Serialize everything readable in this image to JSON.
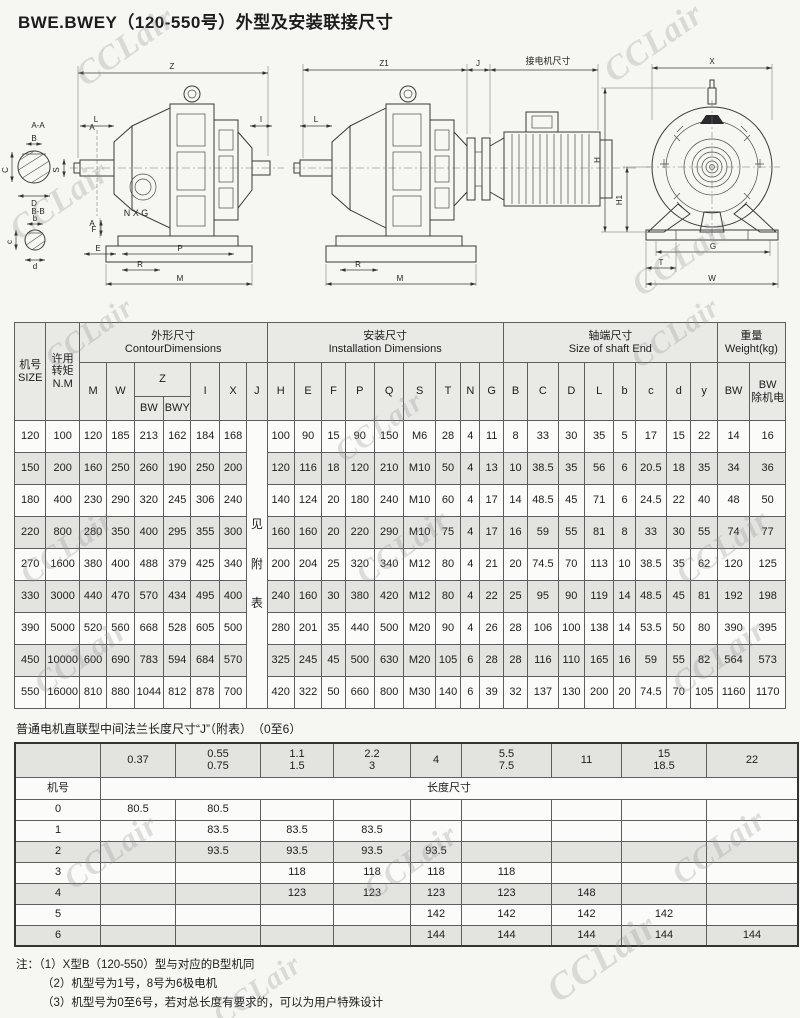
{
  "page": {
    "title": "BWE.BWEY（120-550号）外型及安装联接尺寸",
    "watermark": "CCLair"
  },
  "drawings": {
    "left": {
      "aa": "A-A",
      "bb": "B-B",
      "B": "B",
      "C": "C",
      "D": "D",
      "b": "b",
      "c": "c",
      "d": "d",
      "Z": "Z",
      "L": "L",
      "I": "I",
      "S": "S",
      "A": "A",
      "E": "E",
      "F": "F",
      "R": "R",
      "P": "P",
      "M": "M",
      "NXG": "N X G"
    },
    "middle": {
      "Z1": "Z1",
      "J": "J",
      "motor": "接电机尺寸",
      "L": "L",
      "R": "R",
      "M": "M"
    },
    "right": {
      "X": "X",
      "H": "H",
      "H1": "H1",
      "G": "G",
      "T": "T",
      "W": "W"
    }
  },
  "main_table": {
    "h_size": "机号\nSIZE",
    "h_torque": "许用\n转矩\nN.M",
    "h_contour": "外形尺寸\nContourDimensions",
    "h_install": "安装尺寸\nInstallation  Dimensions",
    "h_shaft": "轴端尺寸\nSize of shaft End",
    "h_weight": "重量\nWeight(kg)",
    "letters": [
      "M",
      "W",
      "Z",
      "I",
      "X",
      "J",
      "H",
      "E",
      "F",
      "P",
      "Q",
      "S",
      "T",
      "N",
      "G",
      "B",
      "C",
      "D",
      "L",
      "b",
      "c",
      "d",
      "y",
      "BW",
      "BW\n除机电"
    ],
    "z_sub": [
      "BW",
      "BWY"
    ],
    "j_note": "见附表",
    "rows": [
      [
        "120",
        "100",
        "120",
        "185",
        "213",
        "162",
        "184",
        "168",
        "100",
        "90",
        "15",
        "90",
        "150",
        "M6",
        "28",
        "4",
        "11",
        "8",
        "33",
        "30",
        "35",
        "5",
        "17",
        "15",
        "22",
        "14",
        "16"
      ],
      [
        "150",
        "200",
        "160",
        "250",
        "260",
        "190",
        "250",
        "200",
        "120",
        "116",
        "18",
        "120",
        "210",
        "M10",
        "50",
        "4",
        "13",
        "10",
        "38.5",
        "35",
        "56",
        "6",
        "20.5",
        "18",
        "35",
        "34",
        "36"
      ],
      [
        "180",
        "400",
        "230",
        "290",
        "320",
        "245",
        "306",
        "240",
        "140",
        "124",
        "20",
        "180",
        "240",
        "M10",
        "60",
        "4",
        "17",
        "14",
        "48.5",
        "45",
        "71",
        "6",
        "24.5",
        "22",
        "40",
        "48",
        "50"
      ],
      [
        "220",
        "800",
        "280",
        "350",
        "400",
        "295",
        "355",
        "300",
        "160",
        "160",
        "20",
        "220",
        "290",
        "M10",
        "75",
        "4",
        "17",
        "16",
        "59",
        "55",
        "81",
        "8",
        "33",
        "30",
        "55",
        "74",
        "77"
      ],
      [
        "270",
        "1600",
        "380",
        "400",
        "488",
        "379",
        "425",
        "340",
        "200",
        "204",
        "25",
        "320",
        "340",
        "M12",
        "80",
        "4",
        "21",
        "20",
        "74.5",
        "70",
        "113",
        "10",
        "38.5",
        "35",
        "62",
        "120",
        "125"
      ],
      [
        "330",
        "3000",
        "440",
        "470",
        "570",
        "434",
        "495",
        "400",
        "240",
        "160",
        "30",
        "380",
        "420",
        "M12",
        "80",
        "4",
        "22",
        "25",
        "95",
        "90",
        "119",
        "14",
        "48.5",
        "45",
        "81",
        "192",
        "198"
      ],
      [
        "390",
        "5000",
        "520",
        "560",
        "668",
        "528",
        "605",
        "500",
        "280",
        "201",
        "35",
        "440",
        "500",
        "M20",
        "90",
        "4",
        "26",
        "28",
        "106",
        "100",
        "138",
        "14",
        "53.5",
        "50",
        "80",
        "390",
        "395"
      ],
      [
        "450",
        "10000",
        "600",
        "690",
        "783",
        "594",
        "684",
        "570",
        "325",
        "245",
        "45",
        "500",
        "630",
        "M20",
        "105",
        "6",
        "28",
        "28",
        "116",
        "110",
        "165",
        "16",
        "59",
        "55",
        "82",
        "564",
        "573"
      ],
      [
        "550",
        "16000",
        "810",
        "880",
        "1044",
        "812",
        "878",
        "700",
        "420",
        "322",
        "50",
        "660",
        "800",
        "M30",
        "140",
        "6",
        "39",
        "32",
        "137",
        "130",
        "200",
        "20",
        "74.5",
        "70",
        "105",
        "1160",
        "1170"
      ]
    ]
  },
  "flange": {
    "caption": "普通电机直联型中间法兰长度尺寸“J”（附表）　（0至6）",
    "size_label": "机号",
    "length_label": "长度尺寸",
    "powers": [
      "0.37",
      "0.55\n0.75",
      "1.1\n1.5",
      "2.2\n3",
      "4",
      "5.5\n7.5",
      "11",
      "15\n18.5",
      "22"
    ],
    "rows": [
      [
        "0",
        "80.5",
        "80.5",
        "",
        "",
        "",
        "",
        "",
        "",
        ""
      ],
      [
        "1",
        "",
        "83.5",
        "83.5",
        "83.5",
        "",
        "",
        "",
        "",
        ""
      ],
      [
        "2",
        "",
        "93.5",
        "93.5",
        "93.5",
        "93.5",
        "",
        "",
        "",
        ""
      ],
      [
        "3",
        "",
        "",
        "118",
        "118",
        "118",
        "118",
        "",
        "",
        ""
      ],
      [
        "4",
        "",
        "",
        "123",
        "123",
        "123",
        "123",
        "148",
        "",
        ""
      ],
      [
        "5",
        "",
        "",
        "",
        "",
        "142",
        "142",
        "142",
        "142",
        ""
      ],
      [
        "6",
        "",
        "",
        "",
        "",
        "144",
        "144",
        "144",
        "144",
        "144"
      ]
    ],
    "shaded": [
      "2",
      "4",
      "6"
    ]
  },
  "notes": {
    "prefix": "注：",
    "items": [
      "（1）X型B（120-550）型与对应的B型机同",
      "（2）机型号为1号，8号为6极电机",
      "（3）机型号为0至6号，若对总长度有要求的，可以为用户特殊设计"
    ]
  }
}
